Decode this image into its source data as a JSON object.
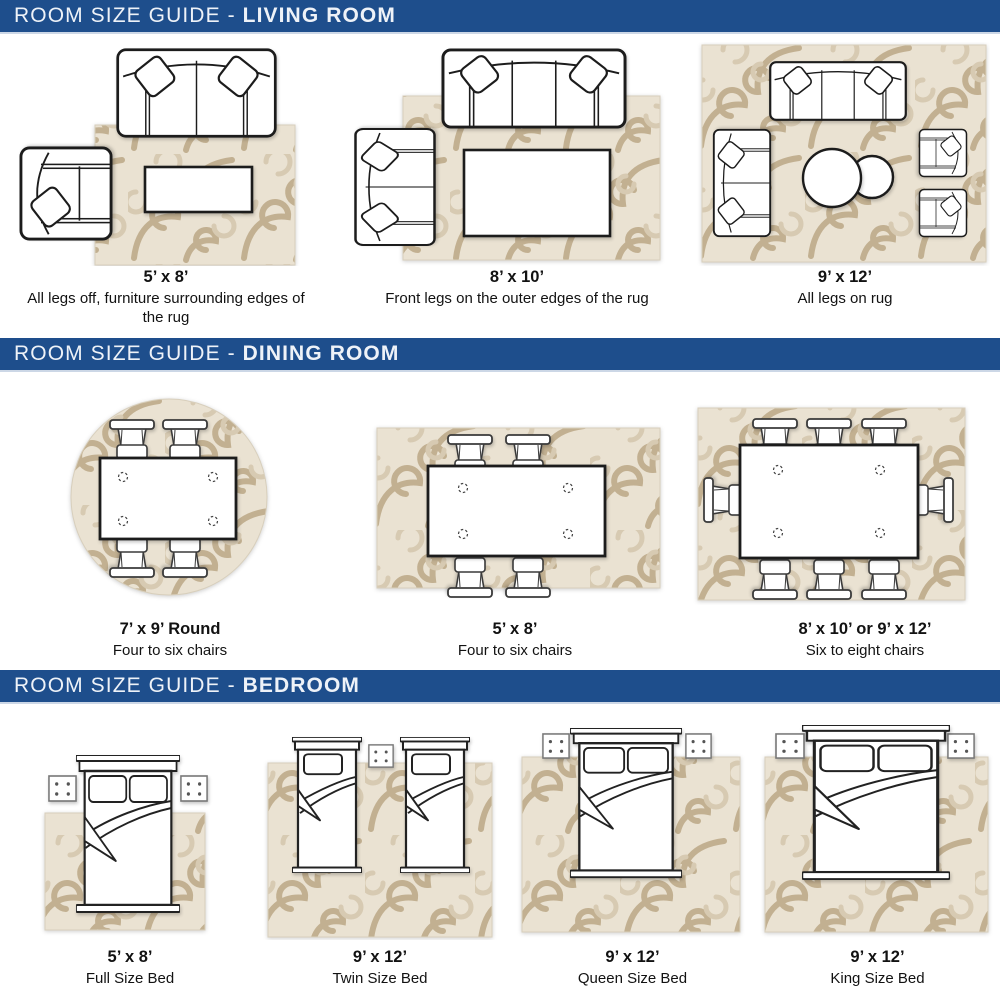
{
  "colors": {
    "header_bg": "#1e4e8c",
    "header_text": "#eef2f8",
    "rug_base": "#eae2d2",
    "rug_swirl_dark": "#c2b091",
    "rug_swirl_light": "#d7cab2",
    "line_color": "#1c1c1c",
    "caption_text": "#121212"
  },
  "icons": {
    "sofa": "sofa-top-view-outline",
    "armchair": "armchair-top-view-outline",
    "loveseat": "loveseat-top-view-outline",
    "coffee_table": "rectangle-table-outline",
    "round_table": "circle-table-outline",
    "dining_chair": "dining-chair-top-view-outline",
    "dining_table": "dining-table-outline",
    "bed": "bed-top-view-outline",
    "nightstand": "nightstand-square-outline",
    "rug": "patterned-area-rug"
  },
  "sections": [
    {
      "title_prefix": "ROOM SIZE GUIDE - ",
      "title_bold": "LIVING ROOM",
      "items": [
        {
          "size": "5’ x 8’",
          "description": "All legs off, furniture surrounding edges of the rug"
        },
        {
          "size": "8’ x 10’",
          "description": "Front legs on the outer edges of the rug"
        },
        {
          "size": "9’ x 12’",
          "description": "All legs on rug"
        }
      ]
    },
    {
      "title_prefix": "ROOM SIZE GUIDE - ",
      "title_bold": "DINING ROOM",
      "items": [
        {
          "size": "7’ x 9’ Round",
          "description": "Four to six chairs"
        },
        {
          "size": "5’ x 8’",
          "description": "Four to six chairs"
        },
        {
          "size": "8’ x 10’ or 9’ x 12’",
          "description": "Six to eight chairs"
        }
      ]
    },
    {
      "title_prefix": "ROOM SIZE GUIDE - ",
      "title_bold": "BEDROOM",
      "items": [
        {
          "size": "5’ x 8’",
          "description": "Full Size Bed"
        },
        {
          "size": "9’ x 12’",
          "description": "Twin Size Bed"
        },
        {
          "size": "9’ x 12’",
          "description": "Queen Size Bed"
        },
        {
          "size": "9’ x 12’",
          "description": "King Size Bed"
        }
      ]
    }
  ]
}
